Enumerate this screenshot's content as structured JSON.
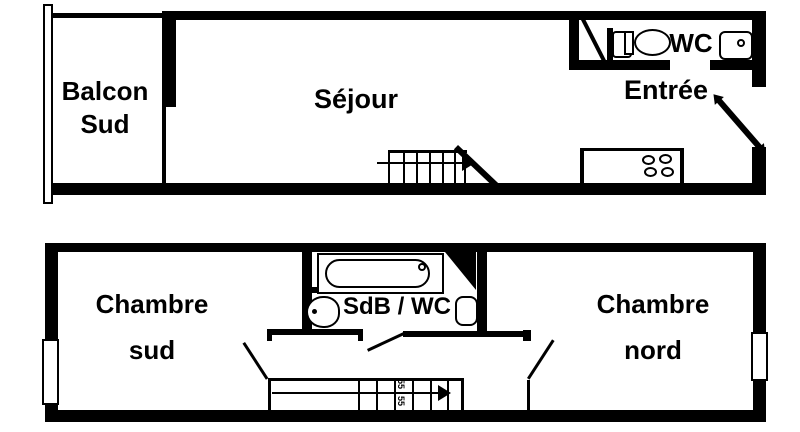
{
  "plan": {
    "upper_floor": {
      "balcony_label_line1": "Balcon",
      "balcony_label_line2": "Sud",
      "living_room_label": "Séjour",
      "entry_label": "Entrée",
      "wc_label": "WC"
    },
    "lower_floor": {
      "bedroom_south_line1": "Chambre",
      "bedroom_south_line2": "sud",
      "bathroom_label": "SdB / WC",
      "bedroom_north_line1": "Chambre",
      "bedroom_north_line2": "nord",
      "stair_mark": "55"
    },
    "colors": {
      "wall": "#000000",
      "background": "#ffffff"
    }
  }
}
